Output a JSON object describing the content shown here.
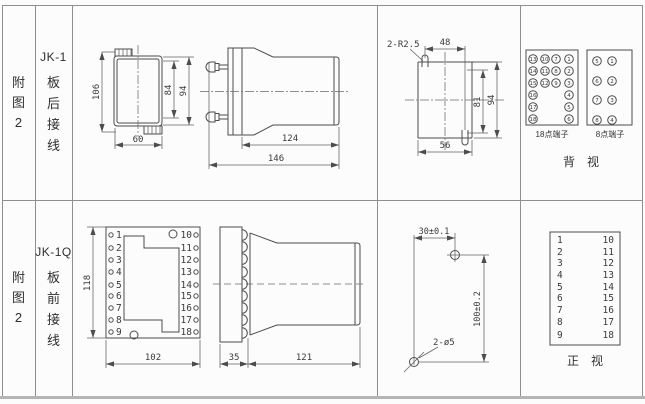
{
  "colors": {
    "line": "#4d4d4d",
    "grid": "#8f8f8f",
    "background": "#fcfcfc",
    "text": "#2f2f2f"
  },
  "row1": {
    "fig_label": "附\n图\n2",
    "model": "JK-1",
    "wiring_label": "板\n后\n接\n线",
    "rear_view": {
      "dim_total_height": "106",
      "dim_inner_height": "84",
      "dim_outer_height": "94",
      "dim_width": "60"
    },
    "side_view": {
      "dim_body": "124",
      "dim_total": "146"
    },
    "cutout": {
      "slot_note": "2-R2.5",
      "dim_top": "48",
      "dim_inner_height": "81",
      "dim_outer_height": "94",
      "dim_width": "56"
    },
    "term18": {
      "caption": "18点端子",
      "numbers": [
        "13",
        "10",
        "7",
        "1",
        "14",
        "11",
        "8",
        "2",
        "15",
        "12",
        "9",
        "3",
        "16",
        "4",
        "17",
        "5",
        "18",
        "6"
      ]
    },
    "term8": {
      "caption": "8点端子",
      "numbers": [
        "5",
        "1",
        "6",
        "2",
        "7",
        "3",
        "8",
        "4"
      ]
    },
    "view_caption": "背　视"
  },
  "row2": {
    "fig_label": "附\n图\n2",
    "model": "JK-1Q",
    "wiring_label": "板\n前\n接\n线",
    "front_view": {
      "dim_height": "118",
      "dim_width": "102",
      "left_terminals": [
        "1",
        "2",
        "3",
        "4",
        "5",
        "6",
        "7",
        "8",
        "9"
      ],
      "right_terminals": [
        "10",
        "11",
        "12",
        "13",
        "14",
        "15",
        "16",
        "17",
        "18"
      ]
    },
    "side_view": {
      "dim_plate": "35",
      "dim_body": "121"
    },
    "drill": {
      "dim_horizontal": "30±0.1",
      "dim_vertical": "100±0.2",
      "holes_note": "2-ø5"
    },
    "table": {
      "left": [
        "1",
        "2",
        "3",
        "4",
        "5",
        "6",
        "7",
        "8",
        "9"
      ],
      "right": [
        "10",
        "11",
        "12",
        "13",
        "14",
        "15",
        "16",
        "17",
        "18"
      ],
      "view_caption": "正　视"
    }
  }
}
